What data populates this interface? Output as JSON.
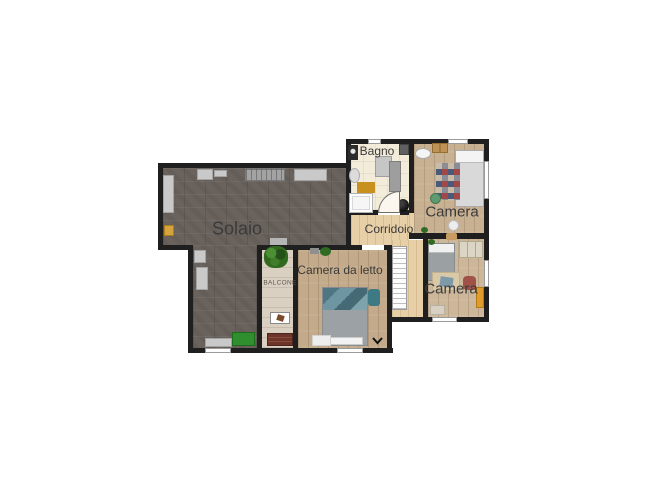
{
  "palette": {
    "background": "#ffffff",
    "wall": "#1f1f1f",
    "solaio_floor": "#6a635d",
    "camera_top_floor": "#c8b192",
    "camera_bottom_floor": "#cdb79a",
    "camera_da_letto_floor": "#c3aa8a",
    "corridor_floor": "#e7d0a7",
    "bagno_floor": "#f3ecda",
    "balcone_floor": "#d9d0c2",
    "label_text": "#3a3a3a",
    "stairs": "#fcfcfc",
    "green_rug": "#2f8f2f",
    "orange_wardrobe": "#e09b2d"
  },
  "rooms": {
    "solaio": {
      "label": "Solaio"
    },
    "bagno": {
      "label": "Bagno"
    },
    "corridoio": {
      "label": "Corridoio"
    },
    "camera_top": {
      "label": "Camera"
    },
    "camera_bottom": {
      "label": "Camera"
    },
    "camera_da_letto": {
      "label": "Camera da letto"
    },
    "balcone": {
      "label": "BALCONE"
    }
  }
}
